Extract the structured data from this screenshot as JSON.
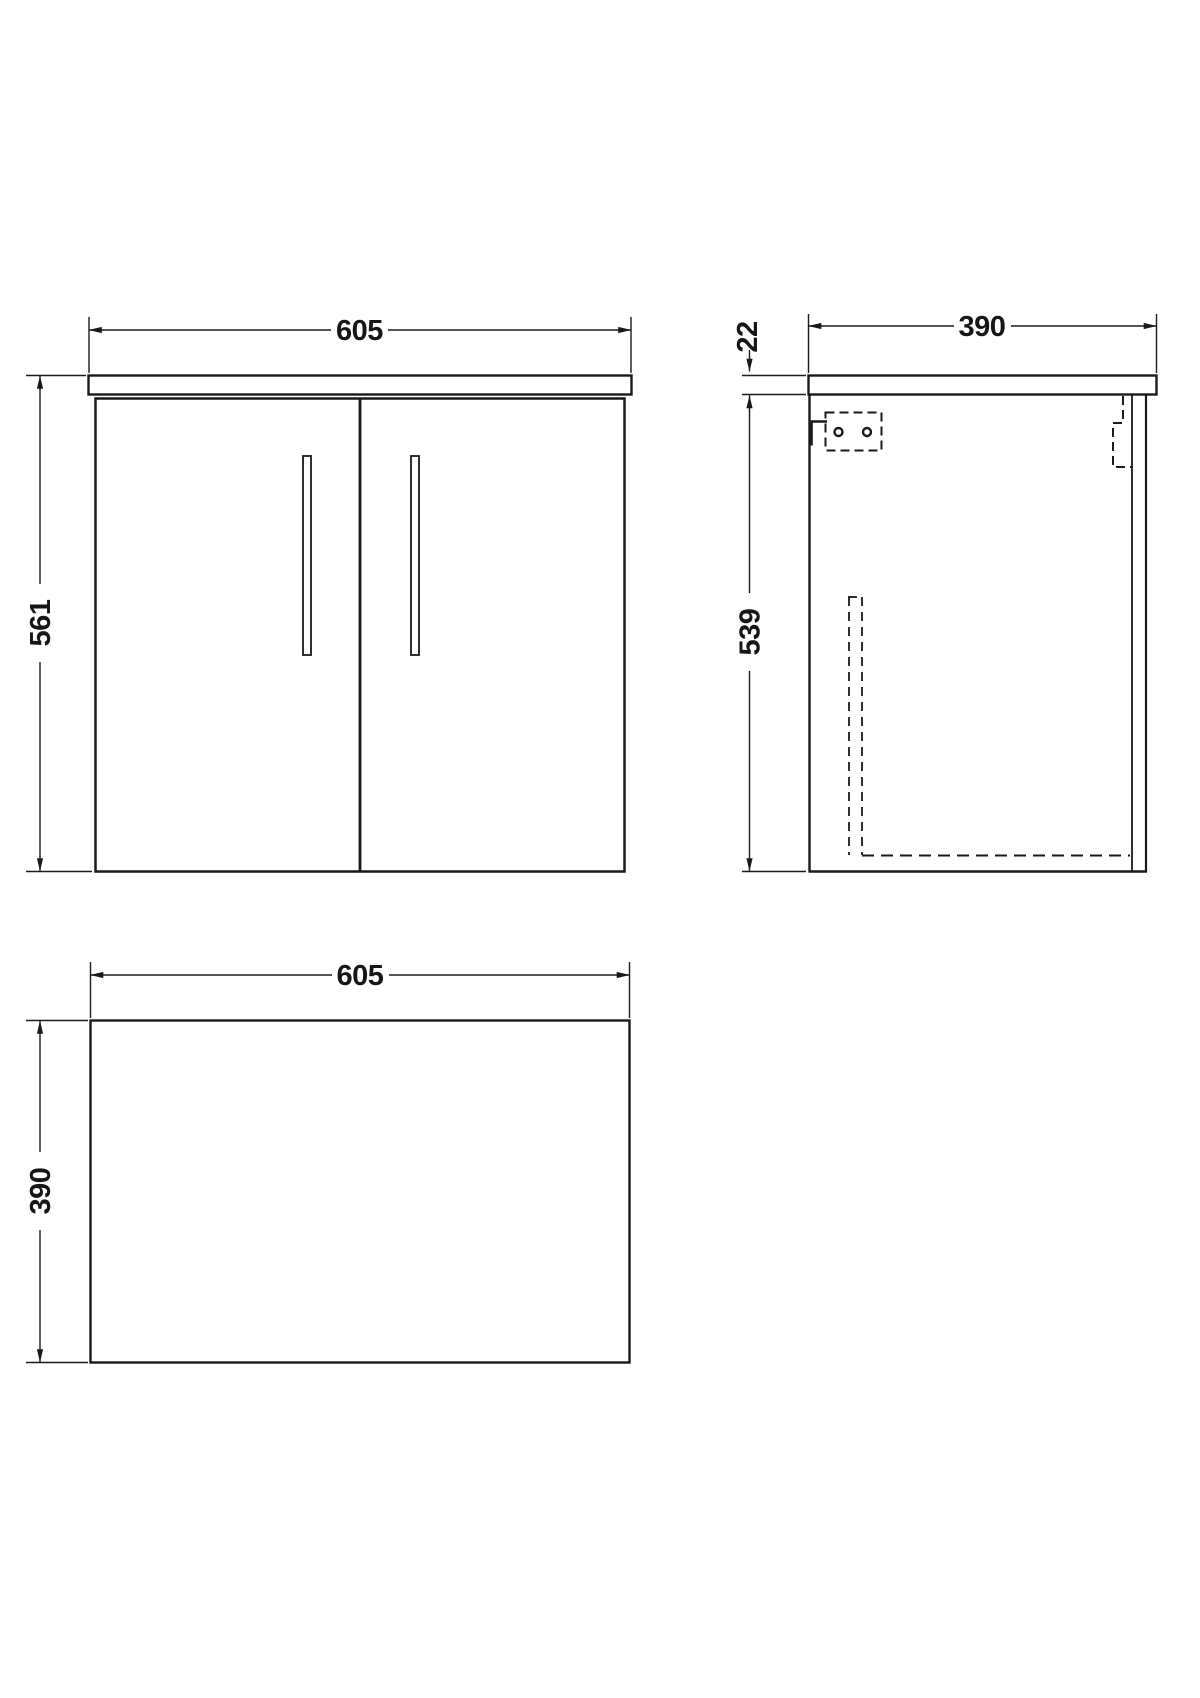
{
  "drawing": {
    "title": "Wall-hung two-door vanity unit — orthographic technical drawing",
    "units": "mm",
    "front_view": {
      "width": "605",
      "height": "561"
    },
    "side_view": {
      "depth": "390",
      "worktop_thickness": "22",
      "cabinet_height": "539"
    },
    "plan_view": {
      "width": "605",
      "depth": "390"
    }
  },
  "colors": {
    "line": "#1a1a1a",
    "background": "#ffffff"
  }
}
